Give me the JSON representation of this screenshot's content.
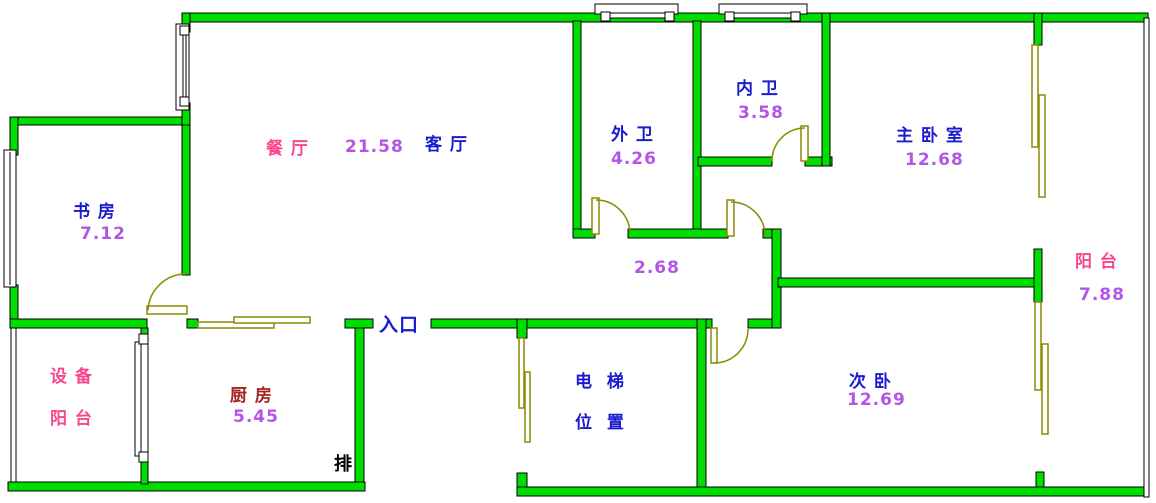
{
  "colors": {
    "wall_green": "#00DD00",
    "room_label_blue": "#1A1ACF",
    "area_value_purple": "#B455E6",
    "balcony_label_pink": "#F9458E",
    "kitchen_label_darkred": "#A32525",
    "door_window_olive": "#8B8B00",
    "outline_black": "#000000"
  },
  "rooms": {
    "dining": {
      "label": "餐 厅",
      "area": "21.58"
    },
    "living": {
      "label": "客 厅"
    },
    "study": {
      "label": "书 房",
      "area": "7.12"
    },
    "outer_bath": {
      "label": "外 卫",
      "area": "4.26"
    },
    "inner_bath": {
      "label": "内 卫",
      "area": "3.58"
    },
    "master_bedroom": {
      "label": "主 卧 室",
      "area": "12.68"
    },
    "balcony": {
      "label": "阳 台",
      "area": "7.88"
    },
    "second_bedroom": {
      "label": "次 卧",
      "area": "12.69"
    },
    "equipment_balcony": {
      "label_line1": "设 备",
      "label_line2": "阳 台"
    },
    "kitchen": {
      "label": "厨 房",
      "area": "5.45"
    },
    "elevator": {
      "label_line1": "电  梯",
      "label_line2": "位  置"
    },
    "corridor": {
      "area": "2.68"
    },
    "entrance": {
      "label": "入口"
    },
    "exhaust": {
      "label": "排"
    }
  }
}
